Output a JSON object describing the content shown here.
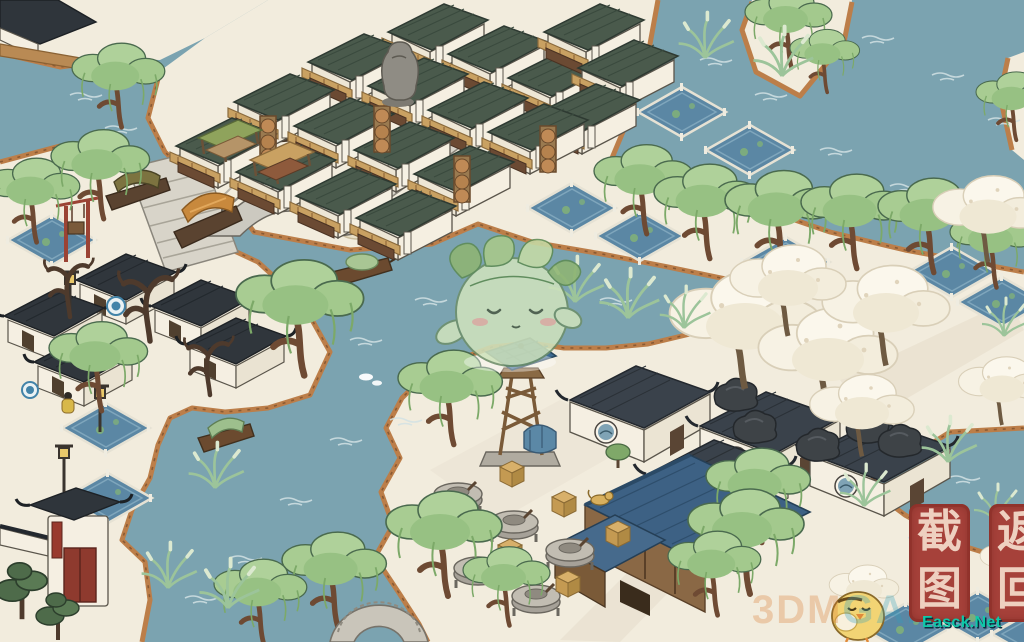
{
  "hud": {
    "screenshot_button": {
      "label": "截图"
    },
    "return_button": {
      "label": "返回"
    }
  },
  "watermarks": {
    "site": "Easck.Net",
    "bg_left": "3DM",
    "bg_right": "GAME"
  },
  "colors": {
    "water": "#7BA3B0",
    "snow": "#F2ECDD",
    "shore_bank": "#BC7E49",
    "shop_roof_green": "#4A5A4C",
    "awning_tan": "#C9A162",
    "hui_roof_dark": "#30363C",
    "blue_tile_roof": "#3D6184",
    "willow_green": "#A8CC92",
    "blossom_white": "#F7F2E6",
    "paddy_blue": "#5B87A4",
    "seal_red": "#A6413A",
    "seal_text": "#EED0C0",
    "watermark_teal": "#0FC8A8"
  },
  "scene": {
    "landmarks": [
      "shop-district",
      "stone-arch-bridge",
      "canal-quay",
      "covered-boats",
      "spirit-character",
      "watchtower",
      "stone-mills",
      "blue-roof-workshop",
      "white-courtyard-houses",
      "blossom-grove",
      "willow-trees",
      "rice-paddies",
      "memorial-gate",
      "moon-arch",
      "chick-character"
    ]
  }
}
